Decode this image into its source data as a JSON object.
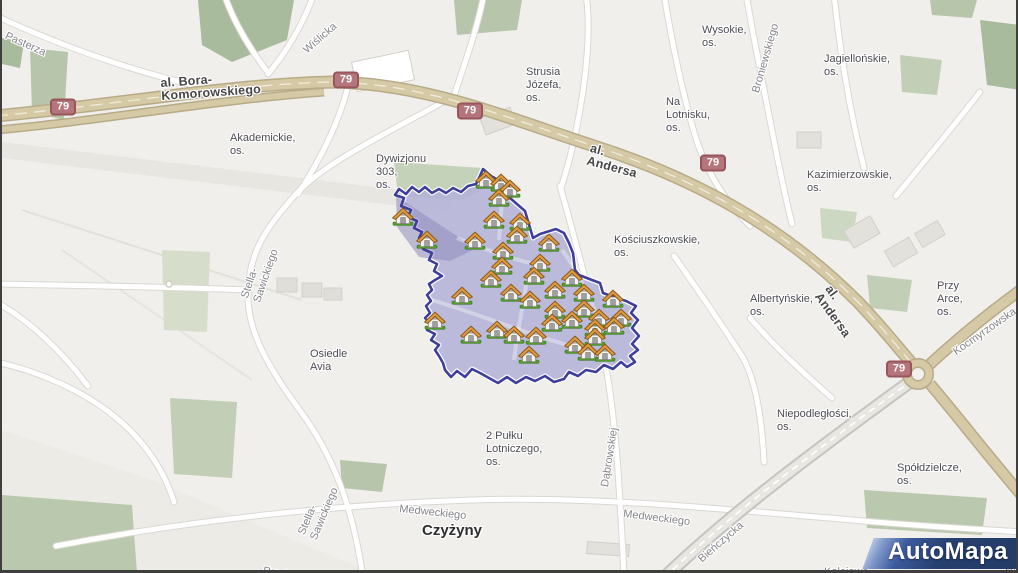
{
  "map": {
    "attribution_logo": "AutoMapa",
    "district_polygon": {
      "fill": "#b2b0d8",
      "stroke": "#3e3e9c",
      "points": "481,169 489,176 507,186 508,198 523,211 531,238 538,234 554,229 562,233 567,243 571,253 573,270 577,275 590,280 598,283 601,293 612,297 624,301 634,306 629,313 636,320 630,328 637,336 630,344 636,350 628,356 633,362 625,367 619,362 611,369 602,365 594,372 584,370 576,376 567,372 562,379 552,382 543,376 533,381 524,377 514,383 505,377 496,383 487,378 478,373 470,369 463,377 455,371 449,377 443,370 441,363 437,356 433,350 437,345 429,340 433,334 425,330 429,324 423,318 428,313 424,306 429,301 425,295 430,290 427,284 433,280 440,276 432,271 435,264 427,260 430,253 421,249 425,242 417,238 420,232 412,228 415,221 406,217 409,210 399,206 402,198 393,195 397,189 404,194 410,187 417,192 423,187 430,193 437,189 444,193 451,188 459,192 466,186 474,184 478,176",
      "inner_shade_points": "394,196 458,238 471,250 448,261 417,257 395,227"
    },
    "houses": [
      [
        484,
        181
      ],
      [
        499,
        184
      ],
      [
        508,
        190
      ],
      [
        497,
        199
      ],
      [
        401,
        218
      ],
      [
        492,
        221
      ],
      [
        518,
        223
      ],
      [
        425,
        241
      ],
      [
        473,
        242
      ],
      [
        515,
        236
      ],
      [
        547,
        244
      ],
      [
        501,
        252
      ],
      [
        500,
        267
      ],
      [
        538,
        264
      ],
      [
        489,
        280
      ],
      [
        570,
        279
      ],
      [
        532,
        277
      ],
      [
        460,
        297
      ],
      [
        509,
        294
      ],
      [
        528,
        301
      ],
      [
        553,
        291
      ],
      [
        582,
        294
      ],
      [
        611,
        300
      ],
      [
        553,
        311
      ],
      [
        582,
        310
      ],
      [
        433,
        322
      ],
      [
        570,
        321
      ],
      [
        597,
        319
      ],
      [
        619,
        319
      ],
      [
        550,
        324
      ],
      [
        469,
        336
      ],
      [
        495,
        331
      ],
      [
        512,
        336
      ],
      [
        534,
        337
      ],
      [
        593,
        329
      ],
      [
        612,
        327
      ],
      [
        593,
        338
      ],
      [
        573,
        346
      ],
      [
        586,
        353
      ],
      [
        603,
        354
      ],
      [
        527,
        356
      ]
    ],
    "badges": [
      {
        "label": "79",
        "x": 61,
        "y": 107
      },
      {
        "label": "79",
        "x": 344,
        "y": 80
      },
      {
        "label": "79",
        "x": 468,
        "y": 111
      },
      {
        "label": "79",
        "x": 711,
        "y": 163
      },
      {
        "label": "79",
        "x": 897,
        "y": 369
      }
    ],
    "labels": [
      {
        "t": "Wysokie,\nos.",
        "x": 700,
        "y": 24,
        "r": 0,
        "c": "area"
      },
      {
        "t": "Jagiellońskie,\nos.",
        "x": 822,
        "y": 53,
        "r": 0,
        "c": "area"
      },
      {
        "t": "Strusia\nJózefa,\nos.",
        "x": 524,
        "y": 66,
        "r": 0,
        "c": "area"
      },
      {
        "t": "Na Lotnisku,\nos.",
        "x": 664,
        "y": 96,
        "r": 0,
        "c": "area"
      },
      {
        "t": "Akademickie,\nos.",
        "x": 228,
        "y": 132,
        "r": 0,
        "c": "area"
      },
      {
        "t": "Dywizjonu\n303,\nos.",
        "x": 374,
        "y": 153,
        "r": 0,
        "c": "area"
      },
      {
        "t": "Kazimierzowskie,\nos.",
        "x": 805,
        "y": 169,
        "r": 0,
        "c": "area"
      },
      {
        "t": "Kościuszkowskie,\nos.",
        "x": 612,
        "y": 234,
        "r": 0,
        "c": "area"
      },
      {
        "t": "Albertyńskie,\nos.",
        "x": 748,
        "y": 293,
        "r": 0,
        "c": "area"
      },
      {
        "t": "Przy\nArce,\nos.",
        "x": 935,
        "y": 280,
        "r": 0,
        "c": "area"
      },
      {
        "t": "Osiedle\nAvia",
        "x": 308,
        "y": 348,
        "r": 0,
        "c": "area"
      },
      {
        "t": "Niepodległości,\nos.",
        "x": 775,
        "y": 408,
        "r": 0,
        "c": "area"
      },
      {
        "t": "Spółdzielcze,\nos.",
        "x": 895,
        "y": 462,
        "r": 0,
        "c": "area"
      },
      {
        "t": "2 Pułku\nLotniczego,\nos.",
        "x": 484,
        "y": 430,
        "r": 0,
        "c": "area"
      },
      {
        "t": "Czyżyny",
        "x": 420,
        "y": 524,
        "r": 0,
        "c": "city"
      },
      {
        "t": "Pasterza",
        "x": 6,
        "y": 30,
        "r": 24,
        "c": "street"
      },
      {
        "t": "Wiślicka",
        "x": 299,
        "y": 47,
        "r": -41,
        "c": "street"
      },
      {
        "t": "Stella-Sawickiego",
        "x": 237,
        "y": 296,
        "r": -71,
        "c": "street"
      },
      {
        "t": "Stella-Sawickiego",
        "x": 294,
        "y": 532,
        "r": -67,
        "c": "street"
      },
      {
        "t": "Medweckiego",
        "x": 398,
        "y": 503,
        "r": 6,
        "c": "street"
      },
      {
        "t": "Medweckiego",
        "x": 622,
        "y": 508,
        "r": 7,
        "c": "street"
      },
      {
        "t": "Dąbrowskiej",
        "x": 597,
        "y": 486,
        "r": -81,
        "c": "street"
      },
      {
        "t": "Bieńczycka",
        "x": 694,
        "y": 556,
        "r": -41,
        "c": "street"
      },
      {
        "t": "Broniewskiego",
        "x": 748,
        "y": 91,
        "r": -74,
        "c": "street"
      },
      {
        "t": "Kocmyrzowska",
        "x": 949,
        "y": 348,
        "r": -35,
        "c": "street"
      },
      {
        "t": "Pawła II",
        "x": 262,
        "y": 565,
        "r": 9,
        "c": "street"
      },
      {
        "t": "Kolejowe",
        "x": 822,
        "y": 566,
        "r": 0,
        "c": "street"
      },
      {
        "t": "Ha",
        "x": 1003,
        "y": 565,
        "r": 0,
        "c": "street"
      },
      {
        "t": "al. Bora-Komorowskiego",
        "x": 158,
        "y": 77,
        "r": -4,
        "c": "road"
      },
      {
        "t": "al. Andersa",
        "x": 590,
        "y": 142,
        "r": 15,
        "c": "road"
      },
      {
        "t": "al. Andersa",
        "x": 831,
        "y": 283,
        "r": 54,
        "c": "road"
      }
    ]
  }
}
